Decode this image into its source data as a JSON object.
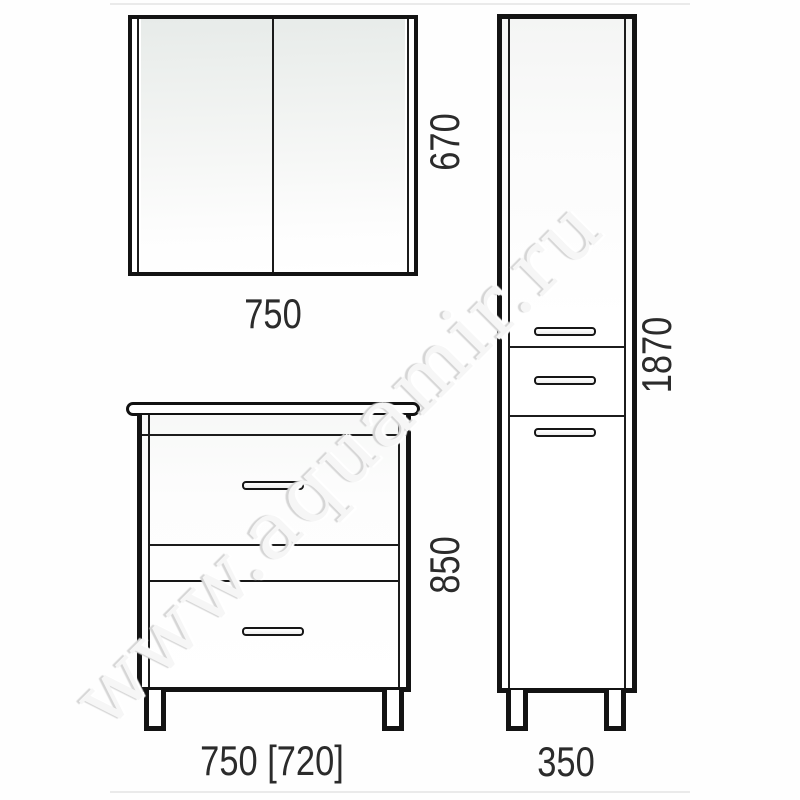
{
  "page": {
    "watermark": "www.aquamir.ru"
  },
  "diagram": {
    "type": "furniture-dimension-drawing",
    "mirror_cabinet": {
      "label_width": "750",
      "label_height": "670",
      "doors": 2
    },
    "vanity_cabinet": {
      "label_width": "750 [720]",
      "label_height": "850",
      "drawers": 2,
      "legs": 2
    },
    "tall_cabinet": {
      "label_width": "350",
      "label_height": "1870",
      "sections": [
        "upper-door",
        "middle-drawer",
        "lower-door"
      ],
      "legs": 2
    },
    "colors": {
      "line": "#131313",
      "label_text": "#2b2b2b",
      "mirror_tint": "#e7ebe9",
      "watermark_text": "#f6f6f6",
      "background": "#fefefe"
    }
  }
}
